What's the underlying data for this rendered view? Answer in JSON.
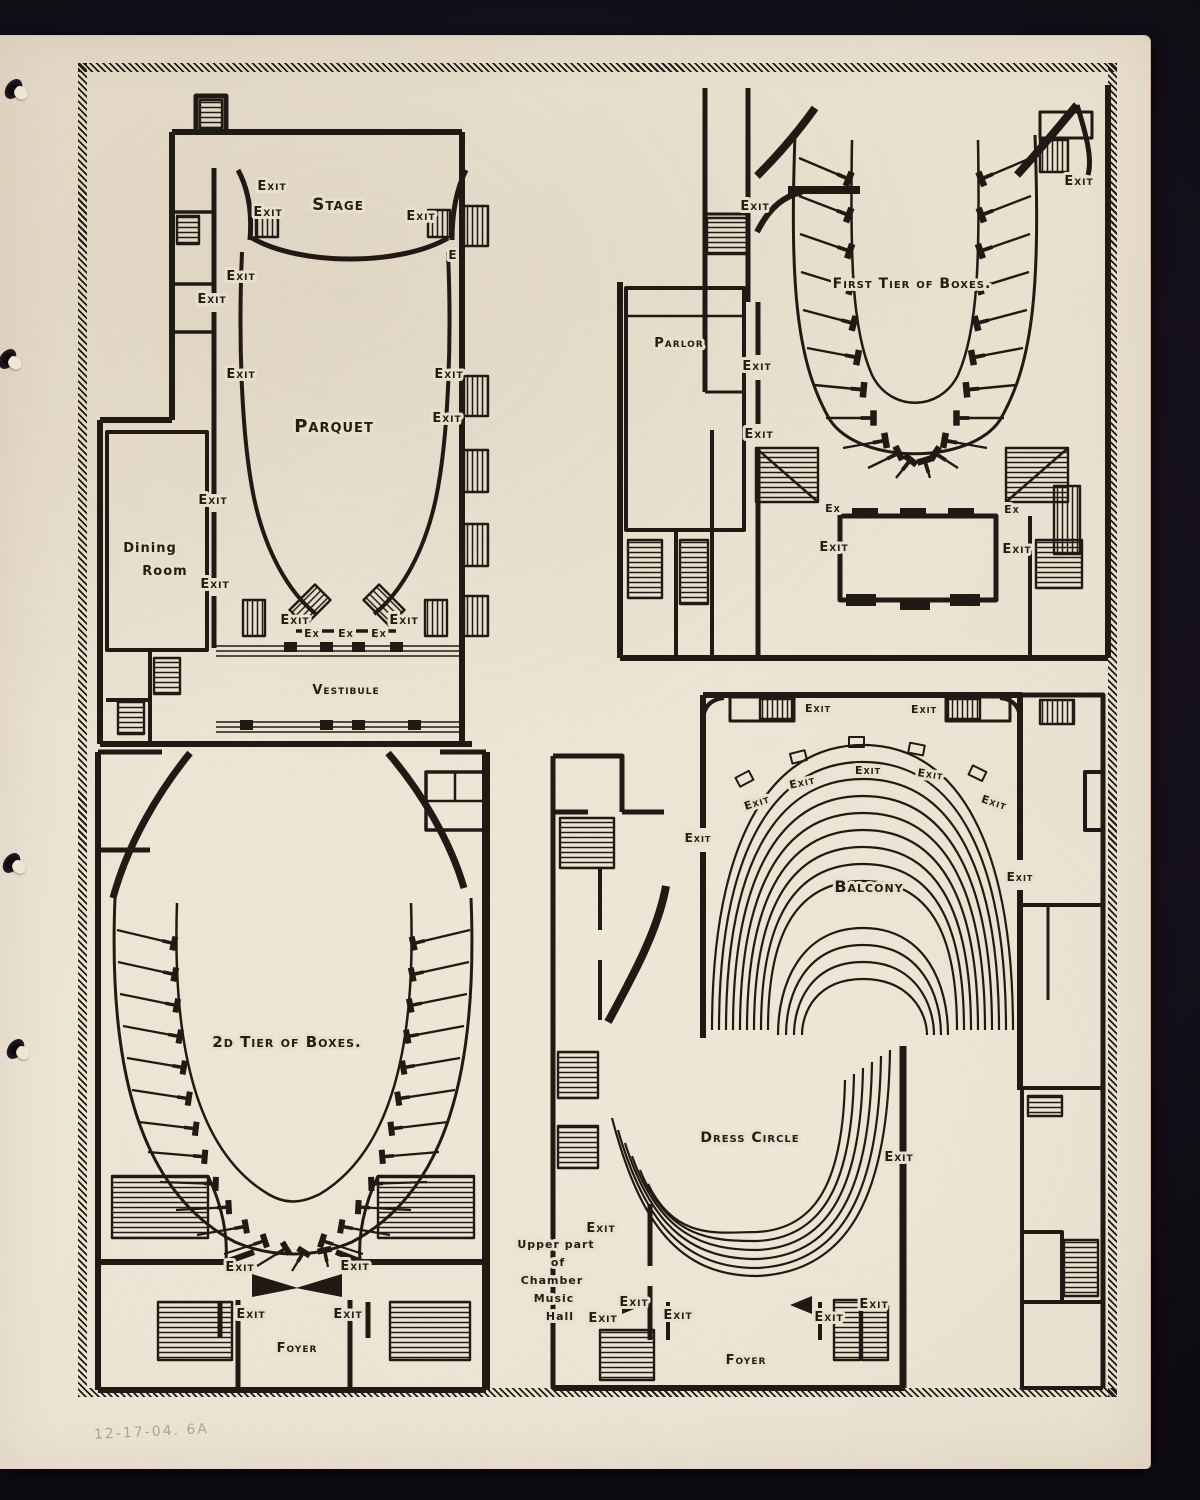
{
  "page": {
    "background_color": "#15111a",
    "paper_color": "#e9dfcd",
    "ink_color": "#201a14",
    "pencil_note": "12-17-04. 6A"
  },
  "plans": {
    "main_floor": {
      "labels": [
        {
          "text": "Stage",
          "x": 338,
          "y": 210,
          "size": 17,
          "spacing": 3
        },
        {
          "text": "Parquet",
          "x": 334,
          "y": 432,
          "size": 18,
          "spacing": 3
        },
        {
          "text": "Dining",
          "x": 150,
          "y": 552,
          "size": 13,
          "style": "hand"
        },
        {
          "text": "Room",
          "x": 165,
          "y": 575,
          "size": 13,
          "style": "hand"
        },
        {
          "text": "Vestibule",
          "x": 346,
          "y": 694,
          "size": 13,
          "spacing": 2
        },
        {
          "text": "Exit",
          "x": 272,
          "y": 190,
          "size": 13
        },
        {
          "text": "Exit",
          "x": 268,
          "y": 216,
          "size": 13
        },
        {
          "text": "Exit",
          "x": 421,
          "y": 220,
          "size": 13
        },
        {
          "text": "E",
          "x": 453,
          "y": 259,
          "size": 12
        },
        {
          "text": "Exit",
          "x": 241,
          "y": 280,
          "size": 13
        },
        {
          "text": "Exit",
          "x": 212,
          "y": 303,
          "size": 13
        },
        {
          "text": "Exit",
          "x": 241,
          "y": 378,
          "size": 13
        },
        {
          "text": "Exit",
          "x": 449,
          "y": 378,
          "size": 13
        },
        {
          "text": "Exit",
          "x": 447,
          "y": 422,
          "size": 13
        },
        {
          "text": "Exit",
          "x": 213,
          "y": 504,
          "size": 13
        },
        {
          "text": "Exit",
          "x": 215,
          "y": 588,
          "size": 13
        },
        {
          "text": "Exit",
          "x": 295,
          "y": 624,
          "size": 13
        },
        {
          "text": "Exit",
          "x": 404,
          "y": 624,
          "size": 13
        },
        {
          "text": "Ex",
          "x": 312,
          "y": 637,
          "size": 11
        },
        {
          "text": "Ex",
          "x": 346,
          "y": 637,
          "size": 11
        },
        {
          "text": "Ex",
          "x": 379,
          "y": 637,
          "size": 11
        }
      ]
    },
    "first_tier": {
      "labels": [
        {
          "text": "First Tier of Boxes.",
          "x": 912,
          "y": 288,
          "size": 14,
          "spacing": 2
        },
        {
          "text": "Parlor",
          "x": 679,
          "y": 347,
          "size": 13,
          "spacing": 1
        },
        {
          "text": "Exit",
          "x": 755,
          "y": 210,
          "size": 13
        },
        {
          "text": "Exit",
          "x": 757,
          "y": 370,
          "size": 13
        },
        {
          "text": "Exit",
          "x": 759,
          "y": 438,
          "size": 13
        },
        {
          "text": "Exit",
          "x": 1079,
          "y": 185,
          "size": 13
        },
        {
          "text": "Ex",
          "x": 833,
          "y": 512,
          "size": 11
        },
        {
          "text": "Exit",
          "x": 834,
          "y": 551,
          "size": 13
        },
        {
          "text": "Ex",
          "x": 1012,
          "y": 513,
          "size": 11
        },
        {
          "text": "Exit",
          "x": 1017,
          "y": 553,
          "size": 13
        }
      ]
    },
    "second_tier": {
      "labels": [
        {
          "text": "2d Tier of Boxes.",
          "x": 287,
          "y": 1047,
          "size": 15,
          "spacing": 2
        },
        {
          "text": "Foyer",
          "x": 297,
          "y": 1352,
          "size": 13,
          "spacing": 2
        },
        {
          "text": "Exit",
          "x": 240,
          "y": 1271,
          "size": 13
        },
        {
          "text": "Exit",
          "x": 355,
          "y": 1270,
          "size": 13
        },
        {
          "text": "Exit",
          "x": 251,
          "y": 1318,
          "size": 13
        },
        {
          "text": "Exit",
          "x": 348,
          "y": 1318,
          "size": 13
        }
      ]
    },
    "balcony_floor": {
      "labels": [
        {
          "text": "Balcony",
          "x": 869,
          "y": 892,
          "size": 16,
          "spacing": 3
        },
        {
          "text": "Dress Circle",
          "x": 750,
          "y": 1142,
          "size": 14,
          "spacing": 1
        },
        {
          "text": "Foyer",
          "x": 746,
          "y": 1364,
          "size": 13,
          "spacing": 2
        },
        {
          "text": "Upper part",
          "x": 556,
          "y": 1248,
          "size": 11,
          "style": "hand"
        },
        {
          "text": "of",
          "x": 558,
          "y": 1266,
          "size": 11,
          "style": "hand"
        },
        {
          "text": "Chamber",
          "x": 552,
          "y": 1284,
          "size": 11,
          "style": "hand"
        },
        {
          "text": "Music",
          "x": 554,
          "y": 1302,
          "size": 11,
          "style": "hand"
        },
        {
          "text": "Hall",
          "x": 560,
          "y": 1320,
          "size": 11,
          "style": "hand"
        },
        {
          "text": "Exit",
          "x": 818,
          "y": 712,
          "size": 11
        },
        {
          "text": "Exit",
          "x": 924,
          "y": 713,
          "size": 11
        },
        {
          "text": "Exit",
          "x": 758,
          "y": 806,
          "size": 11,
          "rotate": -18
        },
        {
          "text": "Exit",
          "x": 803,
          "y": 786,
          "size": 11,
          "rotate": -12
        },
        {
          "text": "Exit",
          "x": 868,
          "y": 774,
          "size": 11
        },
        {
          "text": "Exit",
          "x": 930,
          "y": 778,
          "size": 11,
          "rotate": 8
        },
        {
          "text": "Exit",
          "x": 993,
          "y": 806,
          "size": 11,
          "rotate": 18
        },
        {
          "text": "Exit",
          "x": 698,
          "y": 842,
          "size": 12
        },
        {
          "text": "Exit",
          "x": 1020,
          "y": 881,
          "size": 12
        },
        {
          "text": "Exit",
          "x": 899,
          "y": 1161,
          "size": 13
        },
        {
          "text": "Exit",
          "x": 601,
          "y": 1232,
          "size": 13
        },
        {
          "text": "Exit",
          "x": 634,
          "y": 1306,
          "size": 13
        },
        {
          "text": "Exit",
          "x": 603,
          "y": 1322,
          "size": 13
        },
        {
          "text": "Exit",
          "x": 678,
          "y": 1319,
          "size": 13
        },
        {
          "text": "Exit",
          "x": 829,
          "y": 1321,
          "size": 13
        },
        {
          "text": "Exit",
          "x": 874,
          "y": 1308,
          "size": 13
        }
      ]
    }
  }
}
